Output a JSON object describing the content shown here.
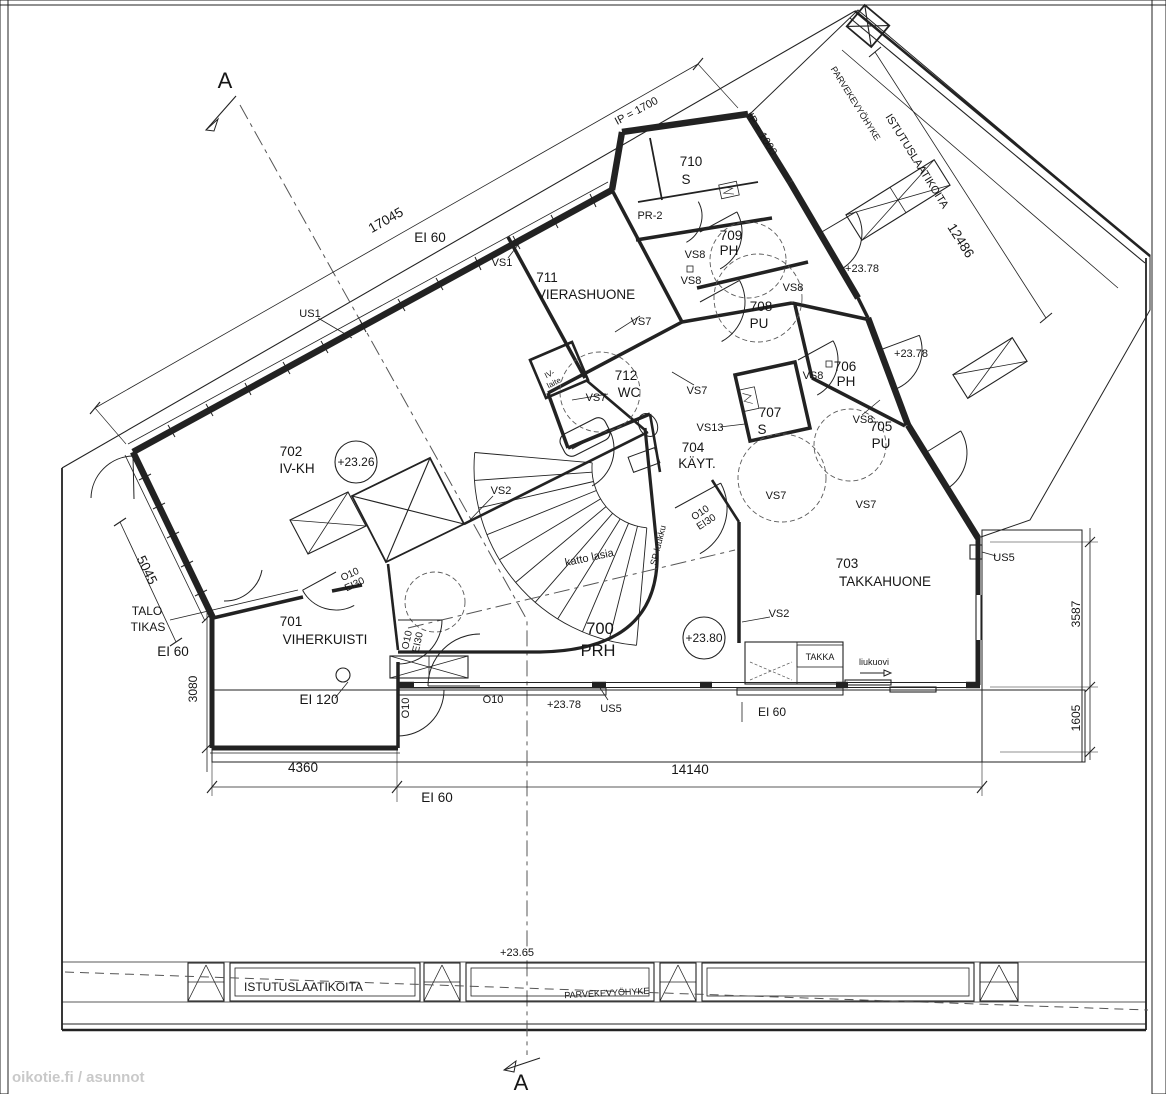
{
  "watermark": "oikotie.fi / asunnot",
  "section": {
    "marker": "A"
  },
  "rooms": {
    "r700": {
      "number": "700",
      "name": "PRH"
    },
    "r701": {
      "number": "701",
      "name": "VIHERKUISTI"
    },
    "r702": {
      "number": "702",
      "name": "IV-KH"
    },
    "r703": {
      "number": "703",
      "name": "TAKKAHUONE"
    },
    "r704": {
      "number": "704",
      "name": "KÄYT."
    },
    "r705": {
      "number": "705",
      "name": "PU"
    },
    "r706": {
      "number": "706",
      "name": "PH"
    },
    "r707": {
      "number": "707",
      "name": "S"
    },
    "r708": {
      "number": "708",
      "name": "PU"
    },
    "r709": {
      "number": "709",
      "name": "PH"
    },
    "r710": {
      "number": "710",
      "name": "S"
    },
    "r711": {
      "number": "711",
      "name": "VIERASHUONE"
    },
    "r712": {
      "number": "712",
      "name": "WC"
    }
  },
  "levels": {
    "l2326": "+23.26",
    "l2378": "+23.78",
    "l2380": "+23.80",
    "l2365": "+23.65"
  },
  "dims": {
    "d17045": "17045",
    "d12486": "12486",
    "d5045": "5045",
    "d3080": "3080",
    "d4360": "4360",
    "d14140": "14140",
    "d3587": "3587",
    "d1605": "1605",
    "ip1700": "IP = 1700",
    "ip1000": "IP = 1000"
  },
  "fire": {
    "ei60": "EI 60",
    "ei120": "EI 120",
    "o10": "O10",
    "ei30": "EI30"
  },
  "walls": {
    "us1": "US1",
    "us5": "US5",
    "vs1": "VS1",
    "vs2": "VS2",
    "vs7": "VS7",
    "vs8": "VS8",
    "vs13": "VS13"
  },
  "ann": {
    "talo": "TALO",
    "tikas": "TIKAS",
    "iv": "IV-",
    "laite": "laite",
    "katto": "katto lasia",
    "sp": "SP-luukku",
    "takka": "TAKKA",
    "liukuovi": "liukuovi",
    "parveke": "PARVEKEVYÖHYKE",
    "istutus": "ISTUTUSLAATIKOITA",
    "pr2": "PR-2"
  }
}
